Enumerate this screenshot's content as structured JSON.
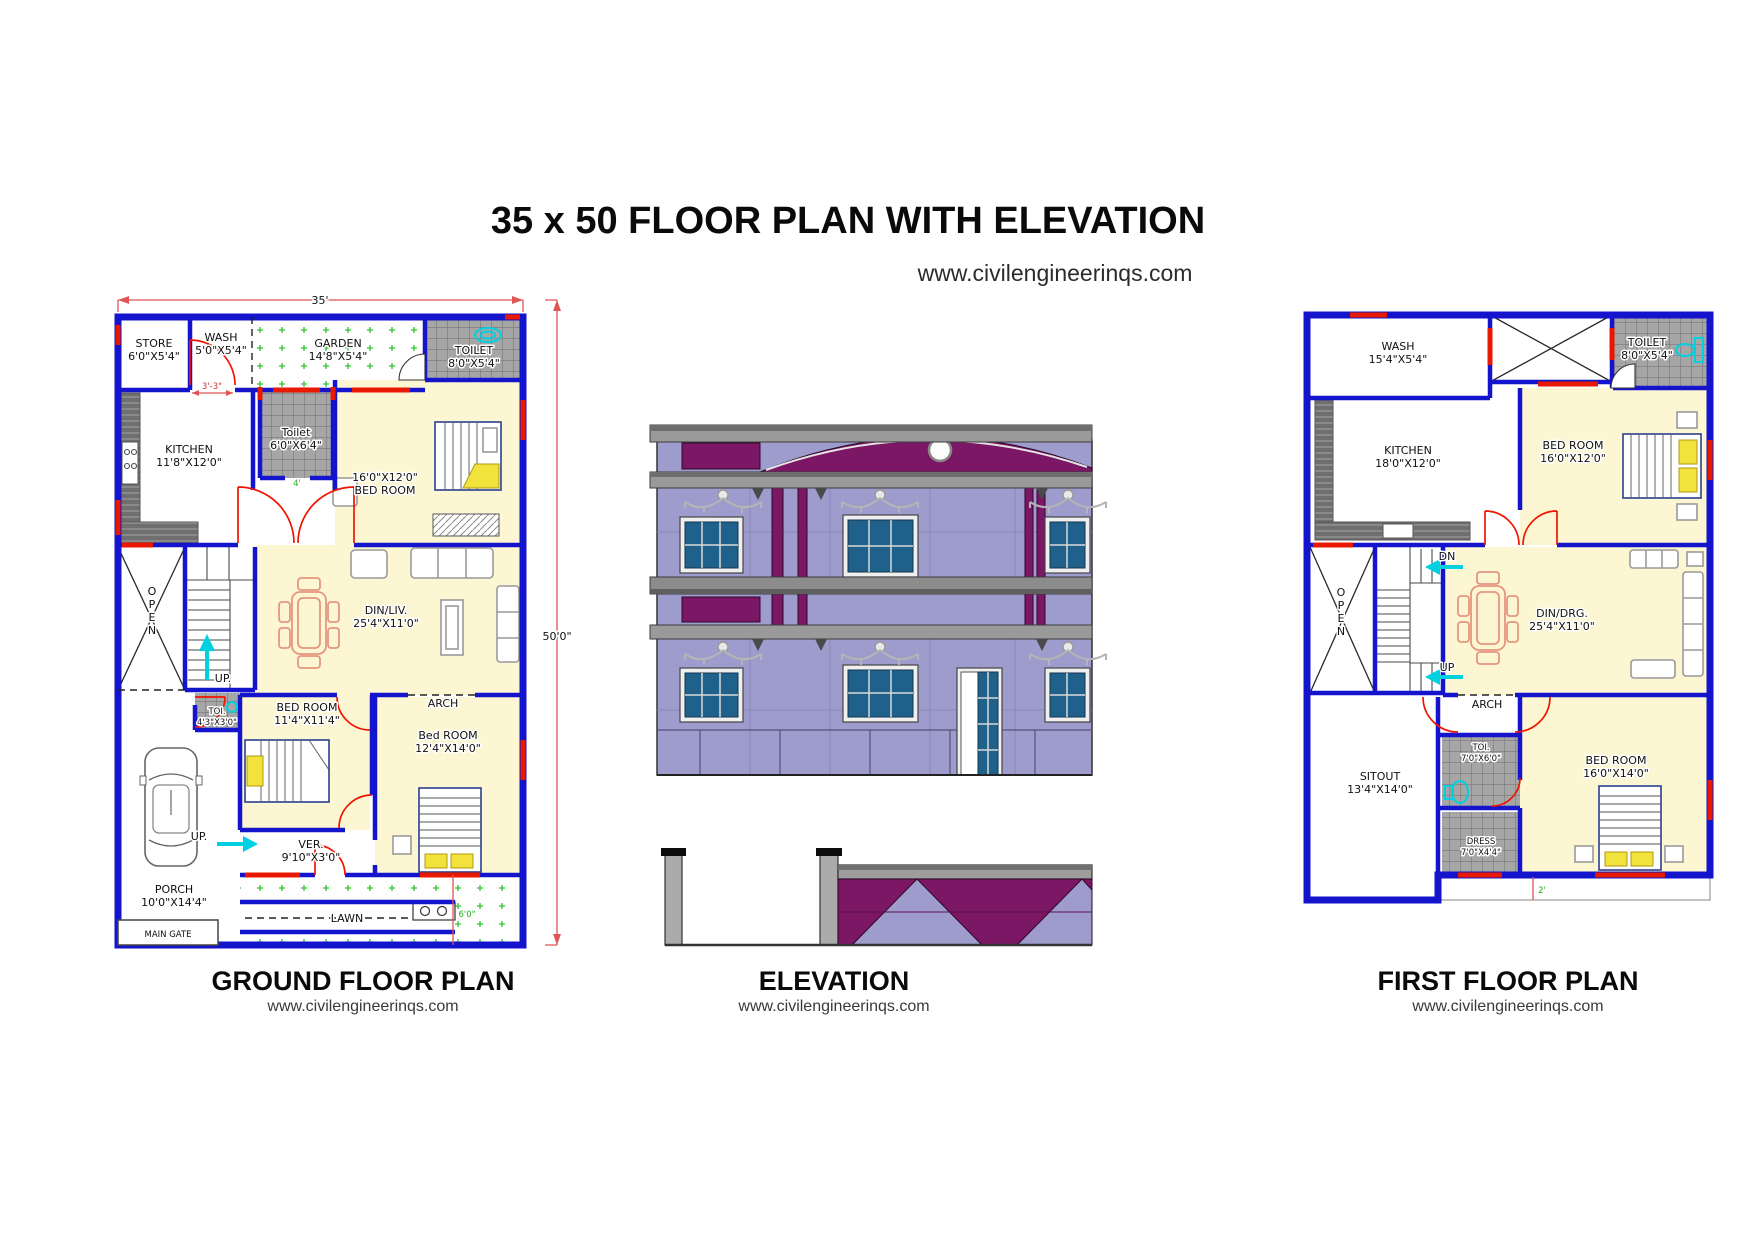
{
  "page": {
    "title": "35 x 50 FLOOR PLAN WITH ELEVATION",
    "website": "www.civilengineerinqs.com"
  },
  "sections": {
    "ground": {
      "label": "GROUND FLOOR PLAN",
      "website": "www.civilengineerinqs.com"
    },
    "elevation": {
      "label": "ELEVATION",
      "website": "www.civilengineerinqs.com"
    },
    "first": {
      "label": "FIRST FLOOR PLAN",
      "website": "www.civilengineerinqs.com"
    }
  },
  "ground_floor": {
    "dim_width": "35'",
    "dim_height": "50'0\"",
    "dim_wash": "3'-3\"",
    "dim_toilet_door": "4'",
    "dim_lawn": "6'0\"",
    "store_name": "STORE",
    "store_size": "6'0\"X5'4\"",
    "wash_name": "WASH",
    "wash_size": "5'0\"X5'4\"",
    "garden_name": "GARDEN",
    "garden_size": "14'8\"X5'4\"",
    "toilet1_name": "TOILET",
    "toilet1_size": "8'0\"X5'4\"",
    "toilet2_name": "Toilet",
    "toilet2_size": "6'0\"X6'4\"",
    "kitchen_name": "KITCHEN",
    "kitchen_size": "11'8\"X12'0\"",
    "bedroom1_size": "16'0\"X12'0\"",
    "bedroom1_name": "BED ROOM",
    "dinliv_name": "DIN/LIV.",
    "dinliv_size": "25'4\"X11'0\"",
    "open": "OPEN",
    "up1": "UP.",
    "up2": "UP.",
    "toi_name": "TOI.",
    "toi_size": "4'3\"X3'0\"",
    "bedroom2_name": "BED ROOM",
    "bedroom2_size": "11'4\"X11'4\"",
    "arch": "ARCH",
    "bedroom3_name": "Bed ROOM",
    "bedroom3_size": "12'4\"X14'0\"",
    "ver_name": "VER.",
    "ver_size": "9'10\"X3'0\"",
    "porch_name": "PORCH",
    "porch_size": "10'0\"X14'4\"",
    "lawn": "LAWN",
    "main_gate": "MAIN GATE"
  },
  "first_floor": {
    "wash_name": "WASH",
    "wash_size": "15'4\"X5'4\"",
    "toilet_name": "TOILET",
    "toilet_size": "8'0\"X5'4\"",
    "kitchen_name": "KITCHEN",
    "kitchen_size": "18'0\"X12'0\"",
    "bedroom1_name": "BED ROOM",
    "bedroom1_size": "16'0\"X12'0\"",
    "open": "OPEN",
    "dn": "DN",
    "up": "UP",
    "dindrg_name": "DIN/DRG.",
    "dindrg_size": "25'4\"X11'0\"",
    "arch": "ARCH",
    "sitout_name": "SITOUT",
    "sitout_size": "13'4\"X14'0\"",
    "toi_name": "TOI.",
    "toi_size": "7'0\"X6'0\"",
    "dress_name": "DRESS",
    "dress_size": "7'0\"X4'4\"",
    "bedroom2_name": "BED ROOM",
    "bedroom2_size": "16'0\"X14'0\"",
    "dim_sunshade": "2'"
  },
  "colors": {
    "wall_blue": "#1414cc",
    "door_red": "#f01500",
    "dim_red": "#e05555",
    "room_yellow": "#fcf6d2",
    "tile_gray": "#a6a6a6",
    "garden_green": "#2dc32d",
    "accent_cyan": "#00d0e0",
    "elevation_wall": "#9e9ccd",
    "elevation_purple": "#7c1766",
    "elevation_slab": "#9a9a9a",
    "window_blue": "#20618b",
    "bed_yellow": "#f2e23c"
  }
}
